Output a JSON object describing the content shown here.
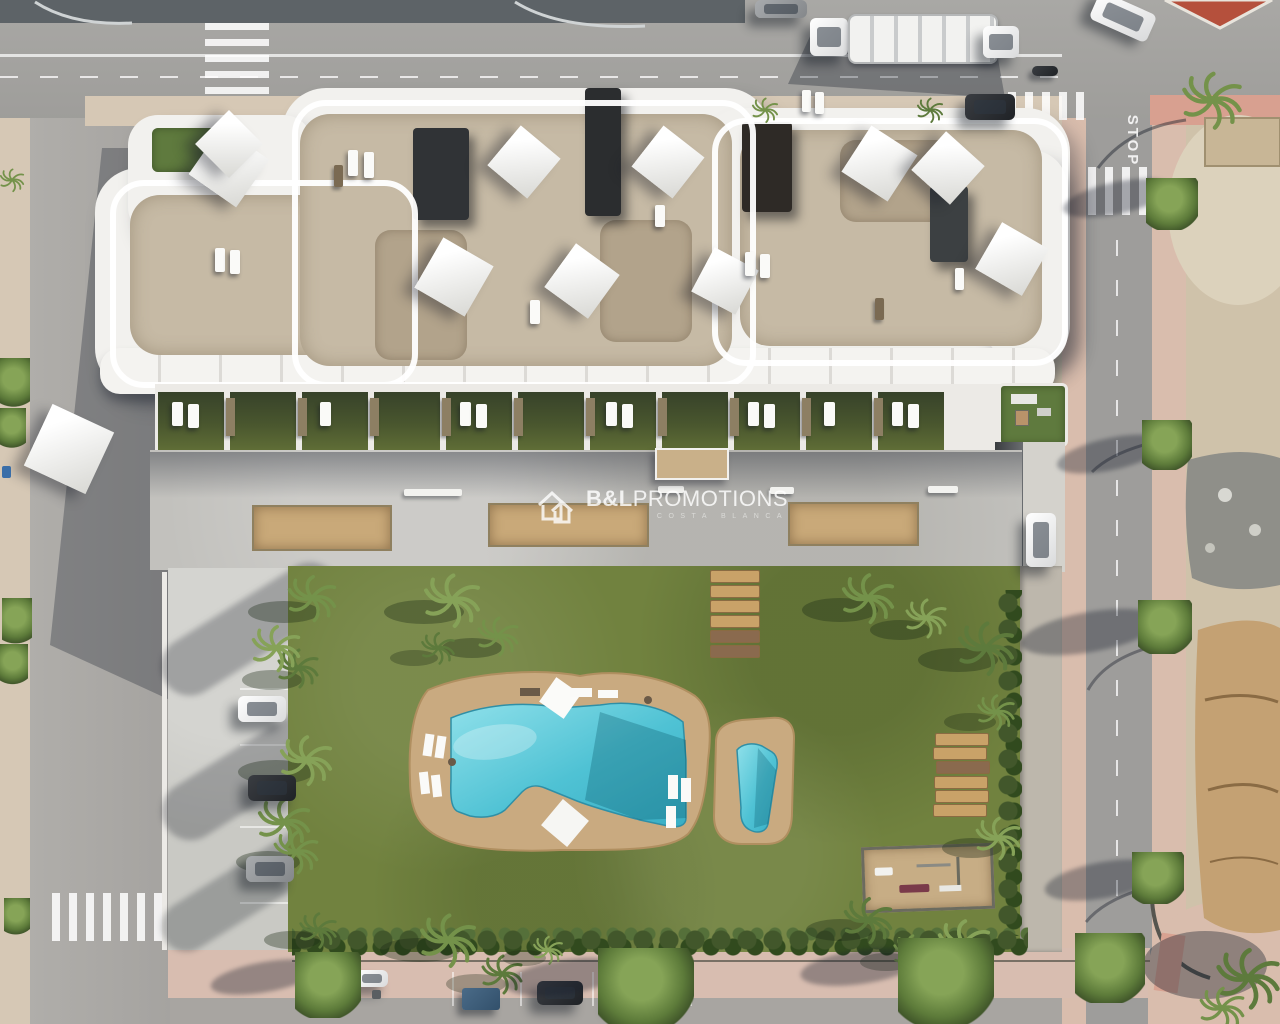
{
  "scene": {
    "label": "Aerial 3D render of an apartment complex with rooftop terraces, communal deck, garden and free-form swimming pool"
  },
  "watermark": {
    "logo_icon": "double-house-outline-icon",
    "brand_bold": "B&L",
    "brand_rest": "PROMOTIONS",
    "subtitle": "COSTA BLANCA"
  },
  "road_markings": {
    "stop": "STOP"
  },
  "palette": {
    "building_white": "#f2f1ee",
    "roof_gravel": "#c6baa5",
    "terrace_lawn": "#46532d",
    "communal_deck": "#c2c1bd",
    "sand_court": "#c9a979",
    "garden_lawn": "#71823f",
    "pool_water": "#4fc2d4",
    "pool_deck": "#c9aa80",
    "asphalt": "#a5a4a2",
    "fresh_asphalt": "#5d6367",
    "sidewalk_pink": "#d9bdad",
    "dirt_lot": "#cfc2aa",
    "hedge_green": "#3f5429",
    "watermark_white": "rgba(255,255,255,0.8)"
  }
}
